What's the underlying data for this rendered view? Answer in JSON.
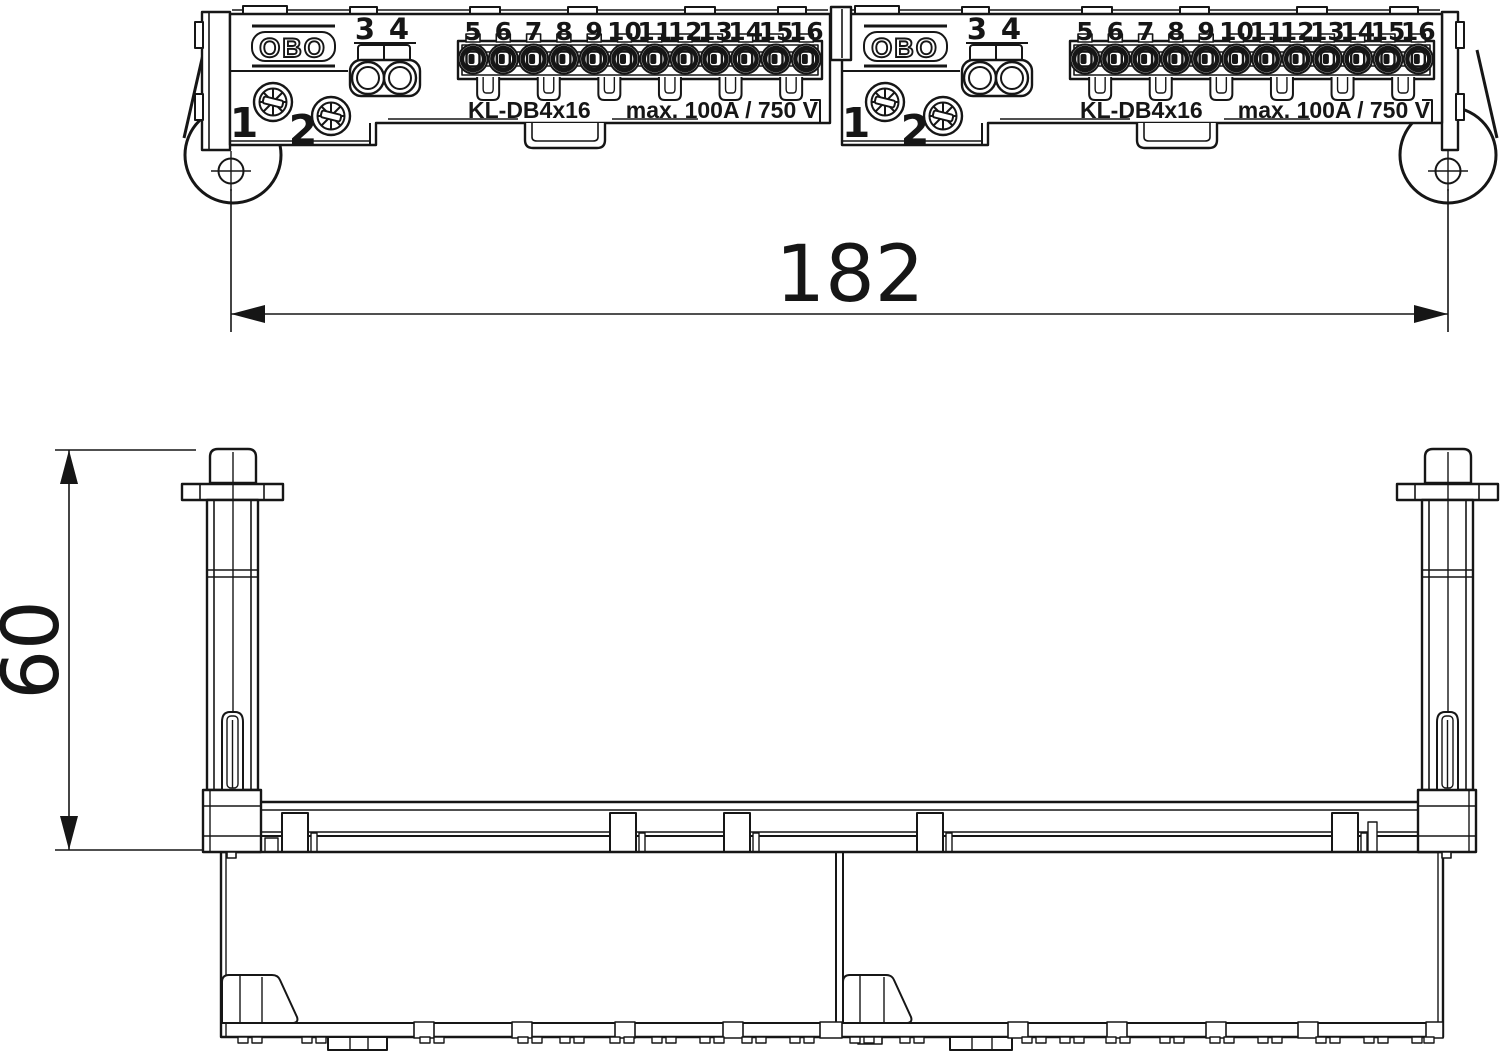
{
  "colors": {
    "background": "#ffffff",
    "line": "#161616"
  },
  "dimension_labels": {
    "width": "182",
    "height": "60"
  },
  "top_view": {
    "modules": [
      {
        "brand": "OBO",
        "screw_labels": [
          "1",
          "2"
        ],
        "pair_labels": [
          "3",
          "4"
        ],
        "terminal_numbers": [
          "5",
          "6",
          "7",
          "8",
          "9",
          "10",
          "11",
          "12",
          "13",
          "14",
          "15",
          "16"
        ],
        "model": "KL-DB4x16",
        "rating": "max. 100A / 750 V"
      },
      {
        "brand": "OBO",
        "screw_labels": [
          "1",
          "2"
        ],
        "pair_labels": [
          "3",
          "4"
        ],
        "terminal_numbers": [
          "5",
          "6",
          "7",
          "8",
          "9",
          "10",
          "11",
          "12",
          "13",
          "14",
          "15",
          "16"
        ],
        "model": "KL-DB4x16",
        "rating": "max. 100A / 750 V"
      }
    ]
  }
}
